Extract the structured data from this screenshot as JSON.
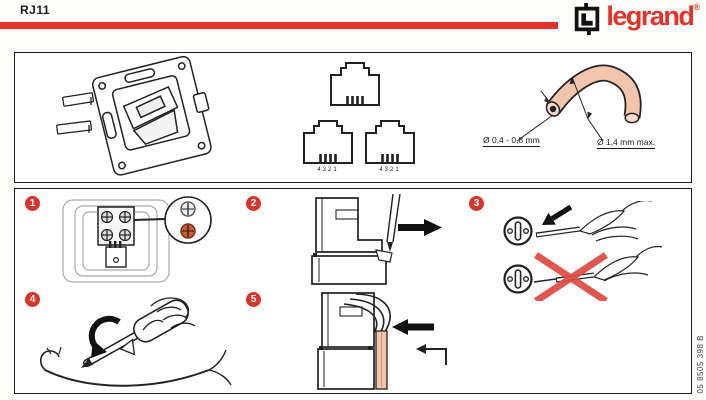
{
  "header": {
    "title": "RJ11",
    "brand": "legrand",
    "registered_mark": "®"
  },
  "top_panel": {
    "plug_pin_numbers": "4321",
    "core_diameter_label": "Ø 0,4 - 0,8 mm",
    "insulation_diameter_label": "Ø 1,4 mm max."
  },
  "steps": [
    {
      "number": "1"
    },
    {
      "number": "2"
    },
    {
      "number": "3"
    },
    {
      "number": "4"
    },
    {
      "number": "5"
    }
  ],
  "footer": {
    "document_ref": "05 8505 398 B"
  },
  "colors": {
    "accent_red": "#e2332a",
    "badge_red": "#d5372c",
    "wire_salmon": "#f2c6ad",
    "cross_red": "#dc4a41"
  }
}
